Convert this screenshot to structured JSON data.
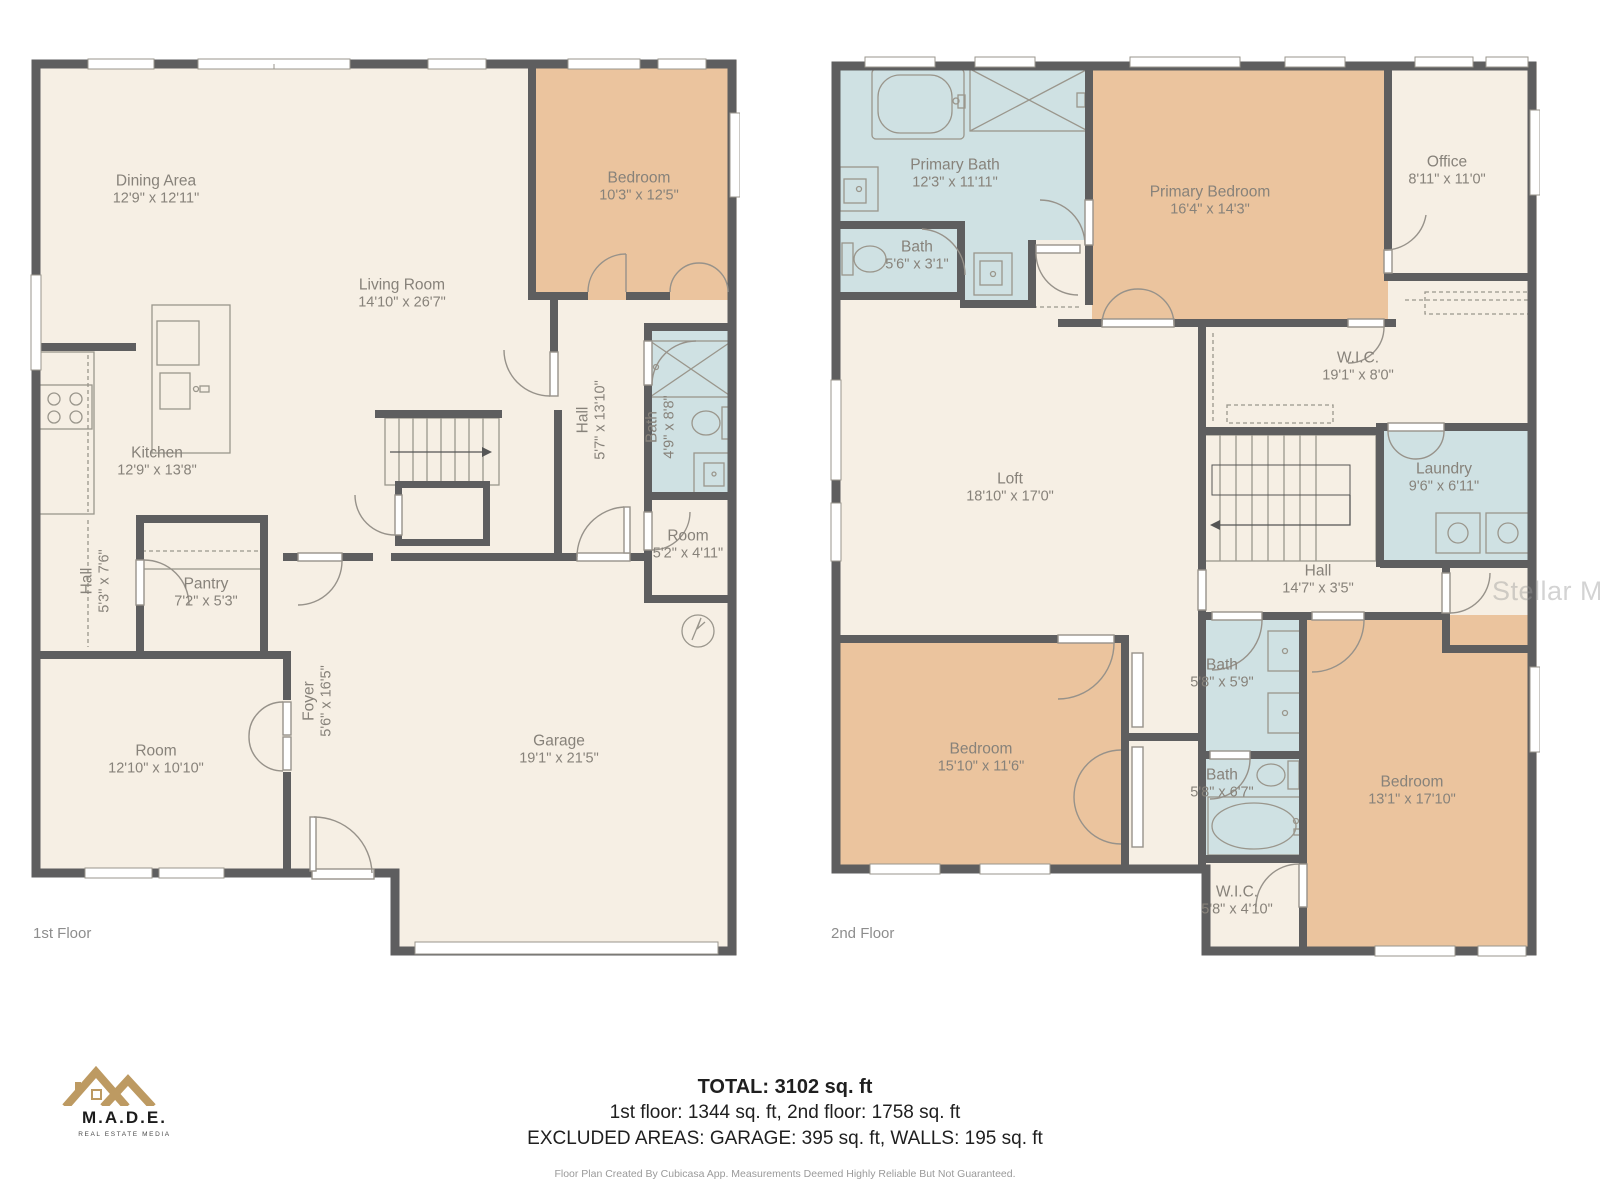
{
  "watermark": "Stellar MLS",
  "floors": [
    {
      "label": "1st Floor",
      "rooms": [
        {
          "name": "Dining Area",
          "dims": "12'9\" x 12'11\""
        },
        {
          "name": "Bedroom",
          "dims": "10'3\" x 12'5\""
        },
        {
          "name": "Living Room",
          "dims": "14'10\" x 26'7\""
        },
        {
          "name": "Kitchen",
          "dims": "12'9\" x 13'8\""
        },
        {
          "name": "Hall",
          "dims": "5'7\" x 13'10\""
        },
        {
          "name": "Bath",
          "dims": "4'9\" x 8'8\""
        },
        {
          "name": "Hall",
          "dims": "5'3\" x 7'6\""
        },
        {
          "name": "Pantry",
          "dims": "7'2\" x 5'3\""
        },
        {
          "name": "Room",
          "dims": "5'2\" x 4'11\""
        },
        {
          "name": "Foyer",
          "dims": "5'6\" x 16'5\""
        },
        {
          "name": "Room",
          "dims": "12'10\" x 10'10\""
        },
        {
          "name": "Garage",
          "dims": "19'1\" x 21'5\""
        }
      ]
    },
    {
      "label": "2nd Floor",
      "rooms": [
        {
          "name": "Primary Bath",
          "dims": "12'3\" x 11'11\""
        },
        {
          "name": "Bath",
          "dims": "5'6\" x 3'1\""
        },
        {
          "name": "Primary Bedroom",
          "dims": "16'4\" x 14'3\""
        },
        {
          "name": "Office",
          "dims": "8'11\" x 11'0\""
        },
        {
          "name": "W.I.C.",
          "dims": "19'1\" x 8'0\""
        },
        {
          "name": "Loft",
          "dims": "18'10\" x 17'0\""
        },
        {
          "name": "Laundry",
          "dims": "9'6\" x 6'11\""
        },
        {
          "name": "Hall",
          "dims": "14'7\" x 3'5\""
        },
        {
          "name": "Bath",
          "dims": "5'8\" x 5'9\""
        },
        {
          "name": "Bedroom",
          "dims": "15'10\" x 11'6\""
        },
        {
          "name": "Bath",
          "dims": "5'8\" x 6'7\""
        },
        {
          "name": "Bedroom",
          "dims": "13'1\" x 17'10\""
        },
        {
          "name": "W.I.C.",
          "dims": "5'8\" x 4'10\""
        }
      ]
    }
  ],
  "summary": {
    "total": "TOTAL: 3102 sq. ft",
    "floors_line": "1st floor: 1344 sq. ft, 2nd floor: 1758 sq. ft",
    "excluded_line": "EXCLUDED AREAS: GARAGE: 395 sq. ft, WALLS: 195 sq. ft",
    "disclaimer": "Floor Plan Created By Cubicasa App. Measurements Deemed Highly Reliable But Not Guaranteed."
  },
  "logo": {
    "name": "M.A.D.E.",
    "tagline": "REAL ESTATE MEDIA"
  },
  "colors": {
    "wall": "#5e5e5f",
    "floor": "#f6efe4",
    "bedroom": "#ebc49e",
    "wet": "#cfe1e3"
  }
}
